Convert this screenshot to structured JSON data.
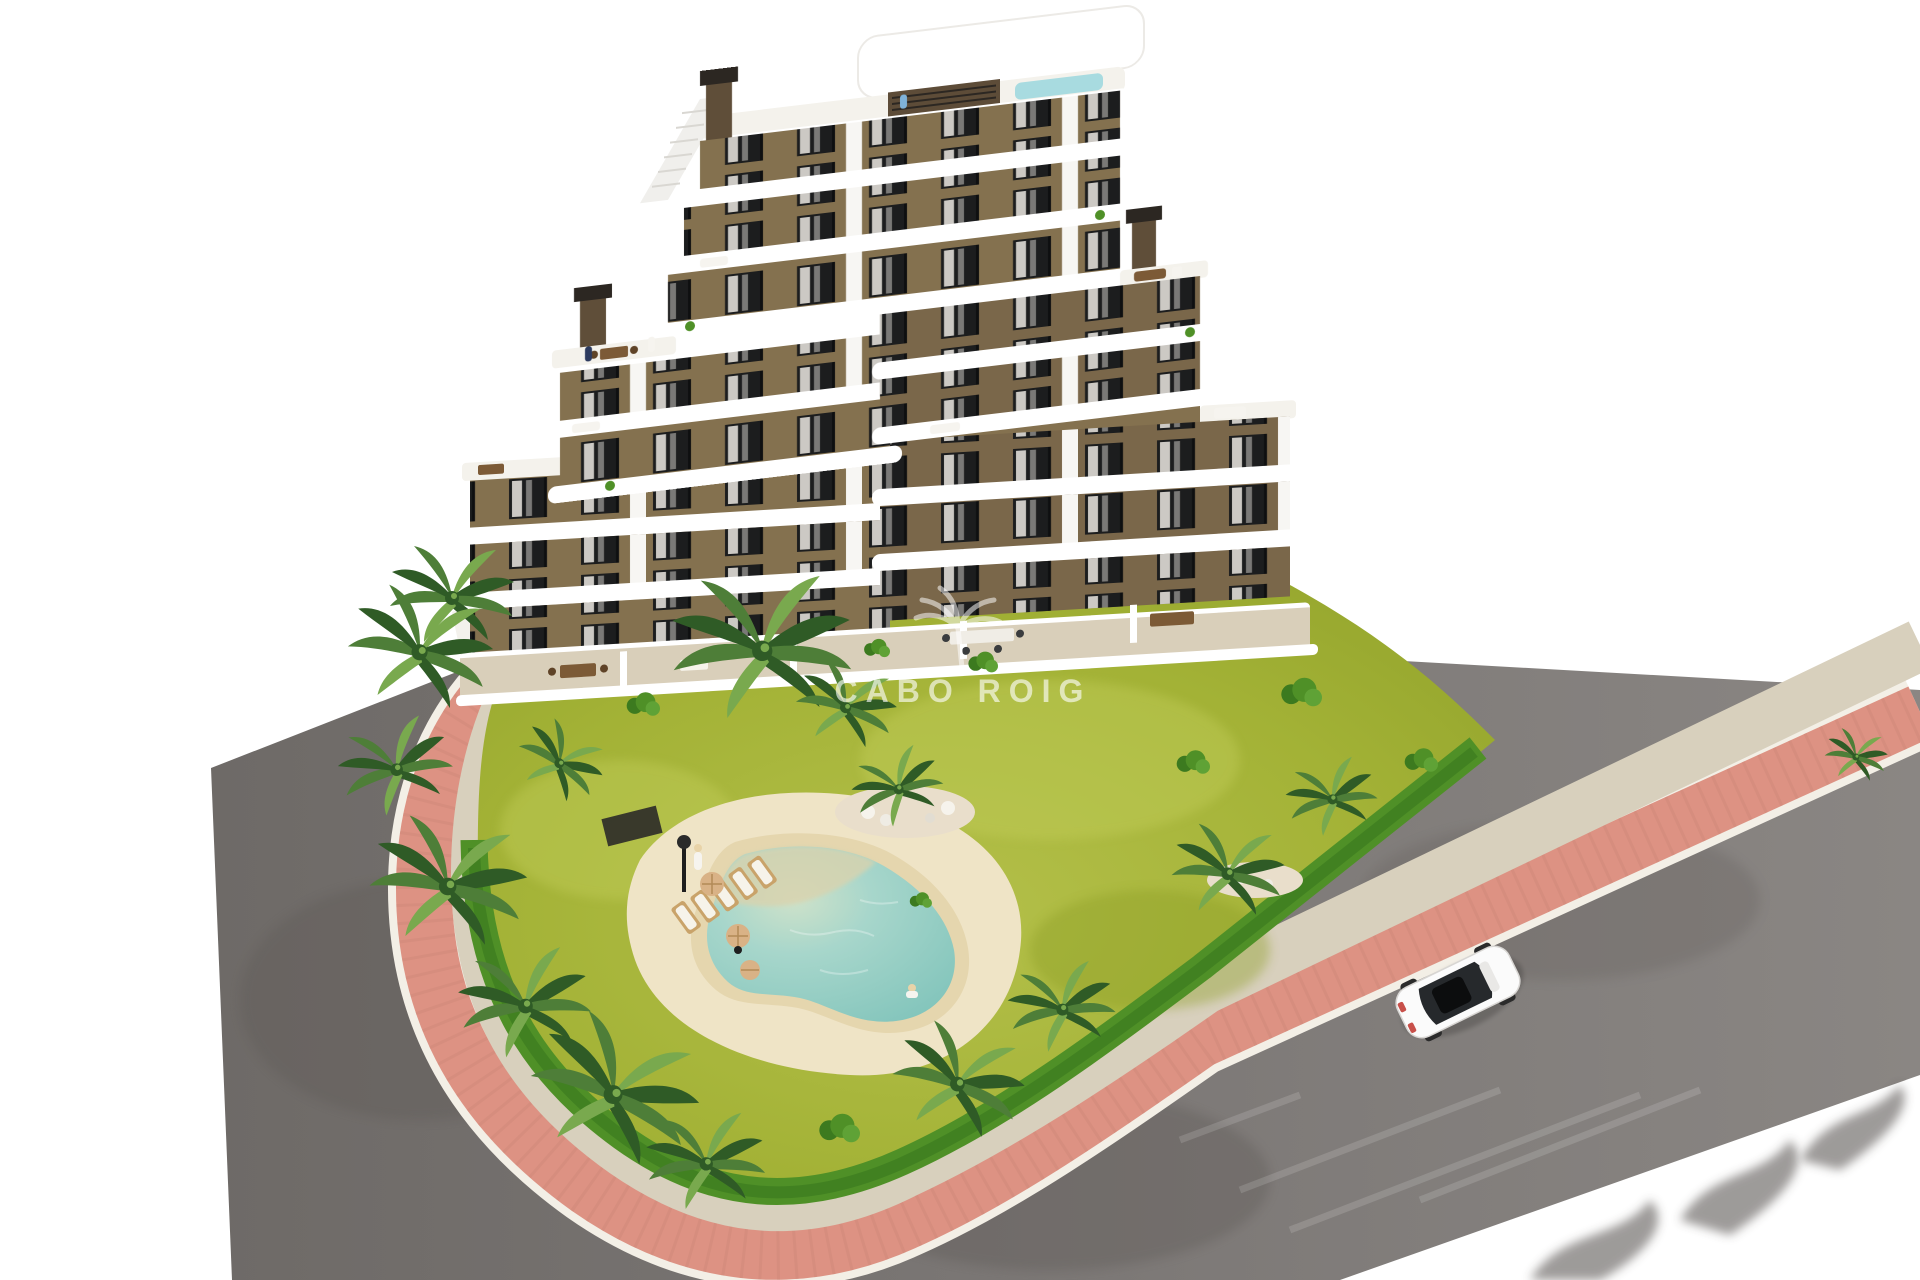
{
  "watermark": {
    "text": "CABO ROIG",
    "icon": "palm-tree-icon"
  },
  "colors": {
    "background": "#ffffff",
    "road_gray": "#7d7977",
    "road_gray_left": "#6e6a67",
    "road_dark_patch": "#5e5a57",
    "path_pink": "#dd9283",
    "curb_white": "#f3efe6",
    "sidewalk_beige": "#d8d0bd",
    "lawn_green": "#a3b236",
    "lawn_light": "#bac64e",
    "hedge_green": "#4f9027",
    "hedge_dark": "#3c7a1f",
    "palm_green": "#4e7e38",
    "palm_dark": "#2f5b26",
    "palm_light": "#79a94e",
    "deck_sand": "#efe4c6",
    "pool_sand_rim": "#e5d6ae",
    "pool_water": "#9ed3c9",
    "pool_water_deep": "#7fc3ba",
    "pool_beach": "#d9d3ae",
    "wall_brown": "#84714f",
    "wall_brown_dark": "#6d5c41",
    "slab_white": "#ffffff",
    "deck_white": "#f4f2ec",
    "glass_dark": "#1c1d1e",
    "curtain_white": "#ebe8e2",
    "terrace_beige": "#d9cfba",
    "chimney_brown": "#5f4e39",
    "chimney_cap": "#2c2722",
    "accent_panel": "#5d4c38",
    "wood_brown": "#7c5a36",
    "umbrella_tan": "#d9b286",
    "rooftop_pool": "#a8dbe0",
    "car_white": "#fbfbfb",
    "car_glass": "#26292c",
    "shadow": "#3c3936",
    "fence_dark": "#2b2a28",
    "person_navy": "#2c3a5e",
    "person_blue": "#7fb2d8",
    "person_white": "#f6f4ef"
  }
}
